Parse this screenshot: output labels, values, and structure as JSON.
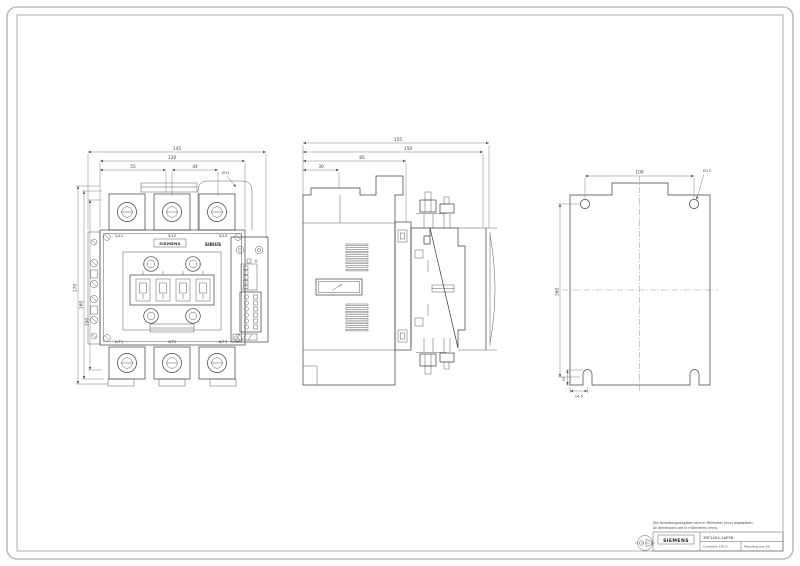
{
  "page": {
    "notes": {
      "line1": "Die Bemaßungsangaben sind in Millimeter (mm) angegeben.",
      "line2": "All dimensions are in millimeters (mm)."
    },
    "title_block": {
      "brand": "SIEMENS",
      "part_number": "3RT1054-1AP36",
      "field_left": "Contactor 100 A",
      "field_right": "Mounting size S6"
    }
  },
  "front_view": {
    "brand": "SIEMENS",
    "series": "SIRIUS",
    "terminal_labels": {
      "top": [
        "1/L1",
        "3/L2",
        "5/L3"
      ],
      "bottom": [
        "2/T1",
        "4/T2",
        "6/T3"
      ]
    },
    "dims": {
      "width_total": "145",
      "width_body": "120",
      "width_left": "55",
      "width_center": "44",
      "hole_dia": "Ø11",
      "height_total": "170",
      "height_mid": "160",
      "height_face": "150"
    }
  },
  "side_view": {
    "dims": {
      "depth_total": "155",
      "depth_mounting": "150",
      "depth_body": "85",
      "depth_front": "30"
    }
  },
  "back_view": {
    "dims": {
      "hole_spacing_h": "100",
      "hole_dia": "Ø13",
      "hole_spacing_v": "160",
      "slot_depth": "10",
      "slot_offset": "14.5"
    }
  }
}
